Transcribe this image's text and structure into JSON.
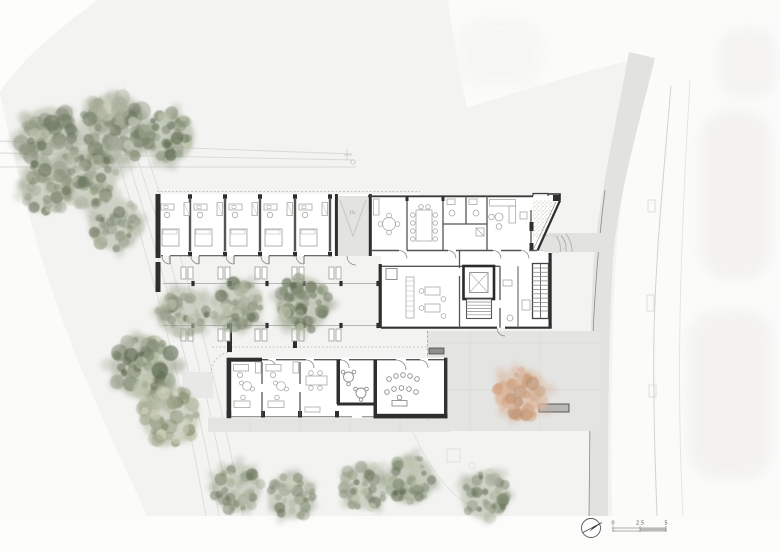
{
  "annotations": {
    "ramp_slope": "1%"
  },
  "scale_bar": {
    "labels": [
      "0",
      "2.5",
      "5"
    ]
  },
  "colors": {
    "sheet": "#fdfdfc",
    "site": "#f3f3f1",
    "path": "#e3e3e1",
    "plaza": "#e4e4e2",
    "pad": "#e8e8e6",
    "wall": "#2e2e2d",
    "wall_mid": "#55555 3",
    "line_faint": "#d8d8d5",
    "furniture": "#a9a9a6",
    "bench_fill": "#b7b7b4",
    "speckle": "#c09f7e"
  },
  "tree_palettes": {
    "sage": {
      "base": "#a8ae9a",
      "mid": "#8d9680",
      "dark": "#6d7860",
      "light": "#c9cdb9"
    },
    "dark": {
      "base": "#99a28b",
      "mid": "#7f8a71",
      "dark": "#5f6b52",
      "light": "#bec4ac"
    },
    "light": {
      "base": "#b3b8a0",
      "mid": "#9aa286",
      "dark": "#7d8868",
      "light": "#d3d5c0"
    },
    "orange": {
      "base": "#dcb79d",
      "mid": "#d2a384",
      "dark": "#bb8e6d",
      "light": "#edd9c6"
    }
  },
  "trees": [
    {
      "x": 50,
      "y": 138,
      "r": 33,
      "variant": "sage",
      "seed": 11
    },
    {
      "x": 114,
      "y": 129,
      "r": 38,
      "variant": "sage",
      "seed": 22
    },
    {
      "x": 169,
      "y": 137,
      "r": 27,
      "variant": "dark",
      "seed": 33
    },
    {
      "x": 88,
      "y": 178,
      "r": 31,
      "variant": "sage",
      "seed": 44
    },
    {
      "x": 47,
      "y": 186,
      "r": 28,
      "variant": "sage",
      "seed": 55
    },
    {
      "x": 115,
      "y": 224,
      "r": 28,
      "variant": "sage",
      "seed": 66
    },
    {
      "x": 183,
      "y": 312,
      "r": 27,
      "variant": "sage",
      "seed": 77
    },
    {
      "x": 237,
      "y": 305,
      "r": 28,
      "variant": "sage",
      "seed": 88
    },
    {
      "x": 303,
      "y": 304,
      "r": 29,
      "variant": "dark",
      "seed": 99
    },
    {
      "x": 143,
      "y": 367,
      "r": 34,
      "variant": "dark",
      "seed": 111
    },
    {
      "x": 170,
      "y": 416,
      "r": 31,
      "variant": "light",
      "seed": 122
    },
    {
      "x": 237,
      "y": 488,
      "r": 26,
      "variant": "sage",
      "seed": 133
    },
    {
      "x": 291,
      "y": 496,
      "r": 25,
      "variant": "sage",
      "seed": 144
    },
    {
      "x": 365,
      "y": 486,
      "r": 25,
      "variant": "sage",
      "seed": 155
    },
    {
      "x": 410,
      "y": 480,
      "r": 26,
      "variant": "dark",
      "seed": 166
    },
    {
      "x": 485,
      "y": 495,
      "r": 26,
      "variant": "sage",
      "seed": 177
    },
    {
      "x": 522,
      "y": 394,
      "r": 28,
      "variant": "orange",
      "seed": 188
    }
  ],
  "pergola": {
    "posts_x": [
      193,
      230,
      267,
      304,
      341,
      378
    ],
    "lines_y": [
      283.5,
      325.5
    ]
  },
  "benches": {
    "garden_clusters": [
      {
        "x": 181,
        "y": 267
      },
      {
        "x": 218,
        "y": 267
      },
      {
        "x": 255,
        "y": 267
      },
      {
        "x": 292,
        "y": 267
      },
      {
        "x": 329,
        "y": 267
      },
      {
        "x": 181,
        "y": 329
      },
      {
        "x": 218,
        "y": 329
      },
      {
        "x": 255,
        "y": 329
      },
      {
        "x": 292,
        "y": 329
      },
      {
        "x": 329,
        "y": 329
      }
    ],
    "plaza_bench": {
      "x": 539,
      "y": 404,
      "w": 30,
      "h": 8
    },
    "garden_sign": {
      "x": 429,
      "y": 348,
      "w": 15,
      "h": 6
    }
  }
}
